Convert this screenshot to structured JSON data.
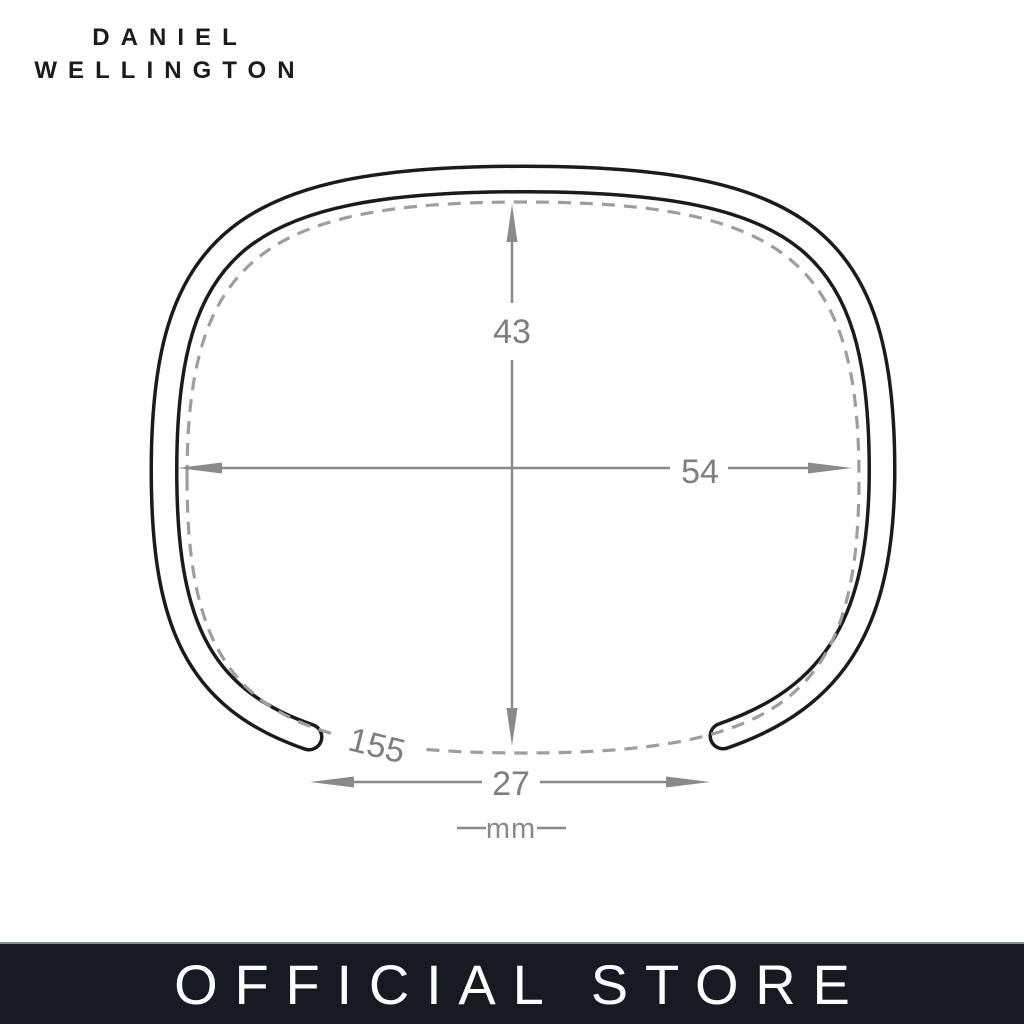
{
  "brand": {
    "line1": "DANIEL",
    "line2": "WELLINGTON"
  },
  "diagram": {
    "type": "cuff-bracelet-dimensions",
    "height_mm": "43",
    "width_mm": "54",
    "circumference_mm": "155",
    "opening_mm": "27",
    "unit": "mm"
  },
  "footer": {
    "label": "OFFICIAL STORE"
  },
  "colors": {
    "ink": "#1b1b1b",
    "dimension_gray": "#8a8a8a",
    "dashed_gray": "#9e9e9e",
    "number_gray": "#7e7e7e",
    "footer_background": "#151a23",
    "footer_text": "#ffffff"
  }
}
